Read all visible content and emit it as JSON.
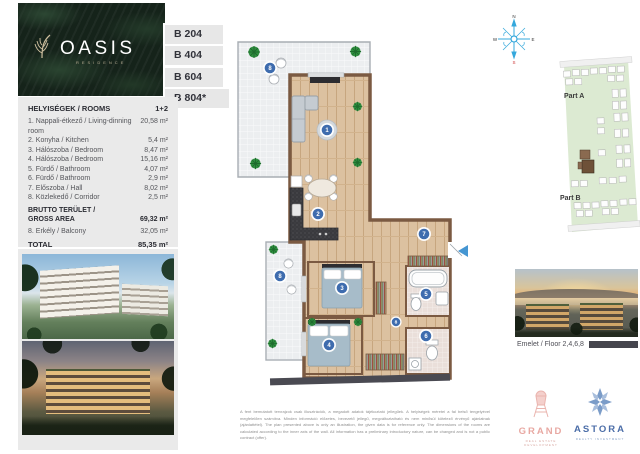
{
  "brand": {
    "name": "OASIS",
    "sub": "RESIDENCE"
  },
  "unit_tags": [
    {
      "label": "B 204"
    },
    {
      "label": "B 404"
    },
    {
      "label": "B 604"
    },
    {
      "label": "B 804*"
    }
  ],
  "rooms_table": {
    "header_left": "HELYISÉGEK / ROOMS",
    "header_right": "1+2",
    "rows": [
      {
        "label": "1. Nappali-étkező / Living-dinning room",
        "value": "20,58 m²"
      },
      {
        "label": "2. Konyha / Kitchen",
        "value": "5,4 m²"
      },
      {
        "label": "3. Hálószoba / Bedroom",
        "value": "8,47 m²"
      },
      {
        "label": "4. Hálószoba / Bedroom",
        "value": "15,16 m²"
      },
      {
        "label": "5. Fürdő / Bathroom",
        "value": "4,07 m²"
      },
      {
        "label": "6. Fürdő / Bathroom",
        "value": "2,9 m²"
      },
      {
        "label": "7. Előszoba / Hall",
        "value": "8,02 m²"
      },
      {
        "label": "8. Közlekedő / Corridor",
        "value": "2,5 m²"
      }
    ],
    "gross_label_1": "BRUTTO TERÜLET /",
    "gross_label_2": "GROSS AREA",
    "gross_value": "69,32 m²",
    "balcony_label": "8. Erkély / Balcony",
    "balcony_value": "32,05 m²",
    "total_label": "TOTAL",
    "total_value": "85,35 m²"
  },
  "plan": {
    "badges": {
      "living": "1",
      "kitchen": "2",
      "bedroom_a": "3",
      "bedroom_b": "4",
      "bathroom_a": "5",
      "bathroom_b": "6",
      "hall": "7",
      "corridor": "8",
      "balcony_top": "8",
      "balcony_side": "8"
    }
  },
  "compass": {
    "n": "N",
    "e": "E",
    "w": "W",
    "s": "S"
  },
  "site_plan": {
    "part_a": "Part A",
    "part_b": "Part B"
  },
  "floor_caption": "Emelet / Floor 2,4,6,8",
  "logos": {
    "grand": {
      "name": "GRAND",
      "tagline": "REAL ESTATE DEVELOPMENT"
    },
    "astora": {
      "name": "ASTORA",
      "tagline": "REALTY INVESTMENT"
    }
  },
  "disclaimer": {
    "hu": "A fent bemutatott tervrajzok csak illusztrációk, a megadott adatok tájékoztató jellegűek. A helyiségek méretei a fal belső tengelyével megfelelően számítva. Minden információ előzetes, bevezető jellegű, megváltoztatható és nem minősül kötelező érvényű ajánlatnak (ajánlattétel).",
    "en": "The plan presented above is only an illustration, the given data is for reference only. The dimensions of the rooms are calculated according to the inner axis of the wall. All information has a preliminary introductory nature, can be changed and is not a public contract (offer)."
  }
}
